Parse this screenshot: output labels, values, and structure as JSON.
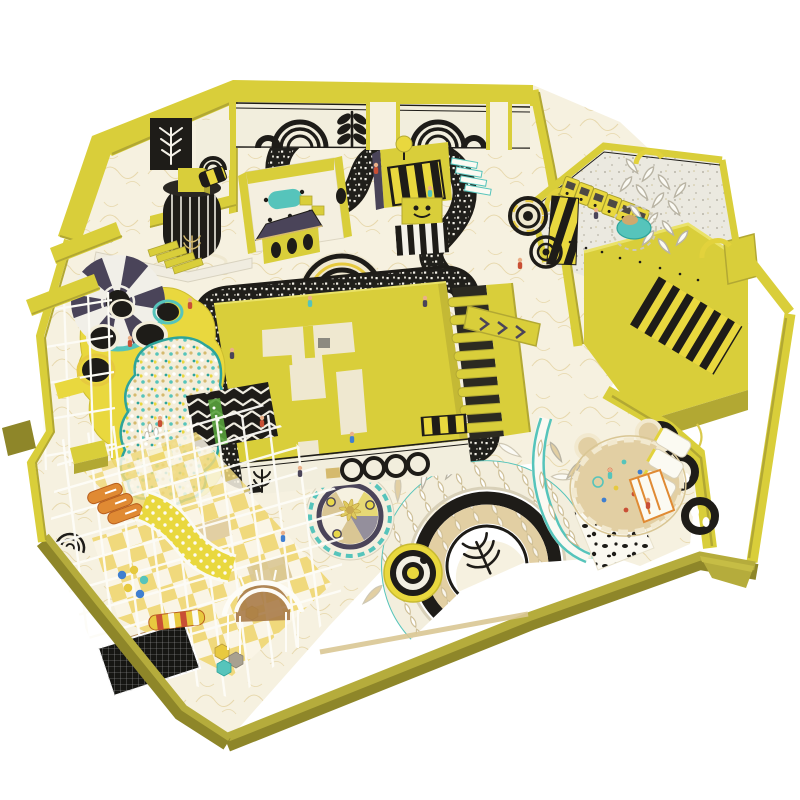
{
  "image": {
    "alt": "Aerial isometric 3D rendering of a yellow and black themed indoor kids playground with trampolines, ball pit, maze walls, mosaic go-kart track, rainbow arch floor art, carousel, claw machines, petal loungers, white climbing frames, slides and a bear-shaped sand pit"
  },
  "palette": {
    "wall": "#d9ce3a",
    "wall_light": "#eae268",
    "wall_dark": "#b2a833",
    "olive": "#b5ac3c",
    "olive_dark": "#8e8629",
    "lemon": "#e9d83e",
    "cream": "#f6f1e0",
    "cream_dark": "#efe8d0",
    "terrazzo": "#ebe9e0",
    "ink": "#1e1c18",
    "navy": "#4a4459",
    "teal": "#56c4bb",
    "teal_deep": "#2da49b",
    "tan": "#d9c694",
    "sand": "#e2cfa3",
    "brown": "#a87b48",
    "gold": "#d5ba6e",
    "orange": "#e08a33",
    "red": "#c94f35",
    "green": "#58a23c",
    "blue": "#3f7fd0",
    "gray": "#948f9c",
    "white_soft": "#fbfaf4"
  },
  "features": [
    "yellow perimeter walls with art-deco black arch and wheat murals",
    "black and white mosaic winding track around a yellow maze block",
    "yellow balloon platform with black trampoline holes and striped cone roof",
    "confetti ball pit with teal rim",
    "white wireframe soft-play structure with checkered floors",
    "black mesh trampoline and orange rollers",
    "teal and tan rainbow arch floor art with leaf motifs",
    "carousel with palm tree and scalloped teal ring",
    "claw machine row and white petal loungers",
    "teal spinner ride",
    "black and yellow hazard striped staircase platform",
    "bear-head shaped sand pit with toy scatter"
  ]
}
